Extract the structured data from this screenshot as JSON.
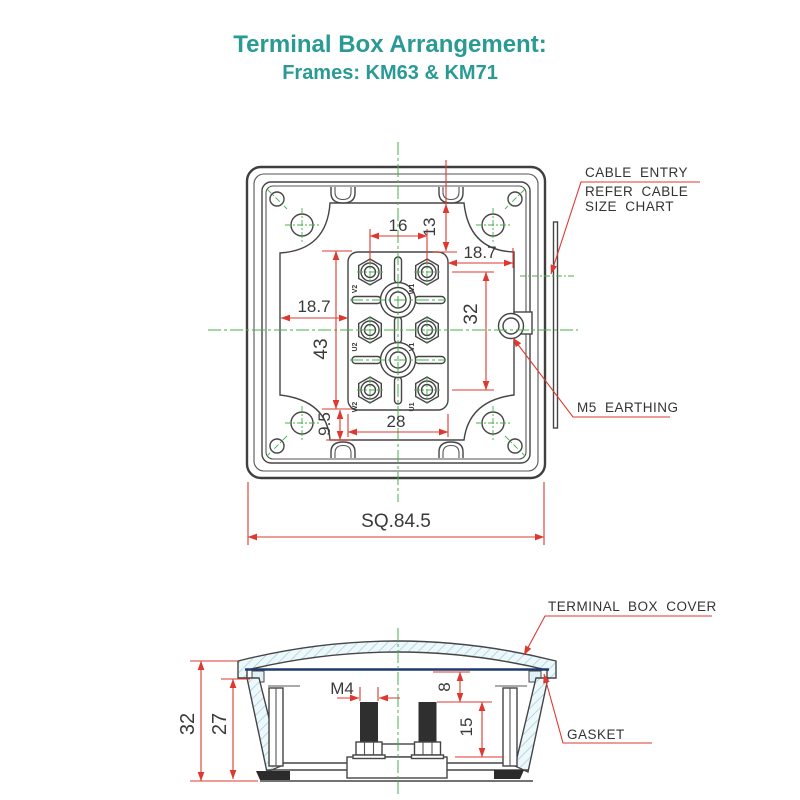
{
  "title": {
    "line1": "Terminal Box Arrangement:",
    "line2": "Frames: KM63 & KM71"
  },
  "plan": {
    "dims": {
      "w16": "16",
      "h13": "13",
      "right18_7": "18.7",
      "left18_7": "18.7",
      "h32": "32",
      "h43": "43",
      "w28": "28",
      "h9_5": "9.5",
      "square": "SQ.84.5"
    },
    "terminals": [
      "V2",
      "W1",
      "U2",
      "V1",
      "W2",
      "U1"
    ],
    "callouts": {
      "cable1": "CABLE ENTRY",
      "cable2": "REFER CABLE",
      "cable3": "SIZE CHART",
      "earthing": "M5 EARTHING"
    }
  },
  "section": {
    "dims": {
      "h32": "32",
      "h27": "27",
      "m4": "M4",
      "d8": "8",
      "d15": "15"
    },
    "callouts": {
      "cover": "TERMINAL BOX COVER",
      "gasket": "GASKET"
    }
  },
  "colors": {
    "title_teal": "#2a9a94",
    "dimension_red": "#dd3930",
    "centerline_green": "#44b04a",
    "line_dark": "#454545",
    "hatch_fill": "#eef8fb",
    "hatch_line": "#9fd4e0",
    "gasket_navy": "#1e3a6e"
  }
}
